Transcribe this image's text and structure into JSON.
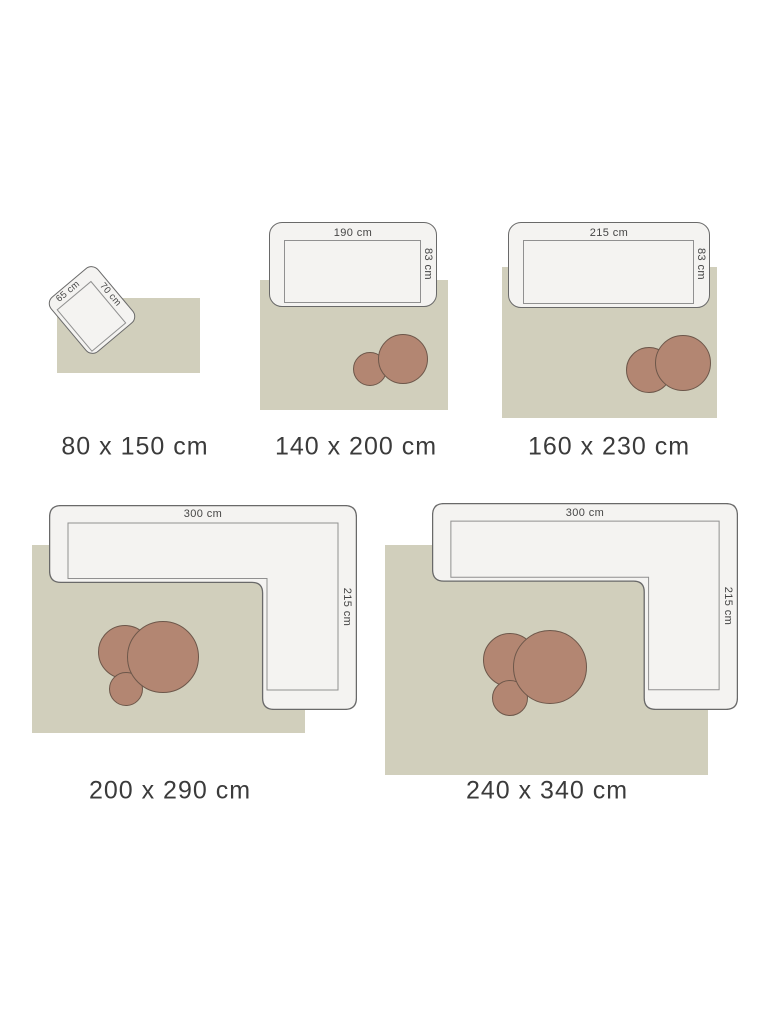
{
  "colors": {
    "background": "#ffffff",
    "rug_fill": "#d1cfbc",
    "furniture_fill": "#f4f3f1",
    "furniture_outline": "#696969",
    "seat_line": "#909090",
    "table_fill": "#b38672",
    "table_outline": "#6d574a",
    "label_text": "#3b3b3b",
    "dim_text": "#454545"
  },
  "groups": [
    {
      "id": "80x150",
      "size_label": "80 x 150 cm",
      "furniture": "armchair",
      "dims": {
        "width": "65 cm",
        "depth": "70 cm"
      }
    },
    {
      "id": "140x200",
      "size_label": "140 x 200 cm",
      "furniture": "sofa",
      "dims": {
        "width": "190 cm",
        "depth": "83 cm"
      }
    },
    {
      "id": "160x230",
      "size_label": "160 x 230 cm",
      "furniture": "sofa",
      "dims": {
        "width": "215 cm",
        "depth": "83 cm"
      }
    },
    {
      "id": "200x290",
      "size_label": "200 x 290 cm",
      "furniture": "corner-sofa",
      "dims": {
        "width": "300 cm",
        "depth": "215 cm"
      }
    },
    {
      "id": "240x340",
      "size_label": "240 x 340 cm",
      "furniture": "corner-sofa",
      "dims": {
        "width": "300 cm",
        "depth": "215 cm"
      }
    }
  ]
}
